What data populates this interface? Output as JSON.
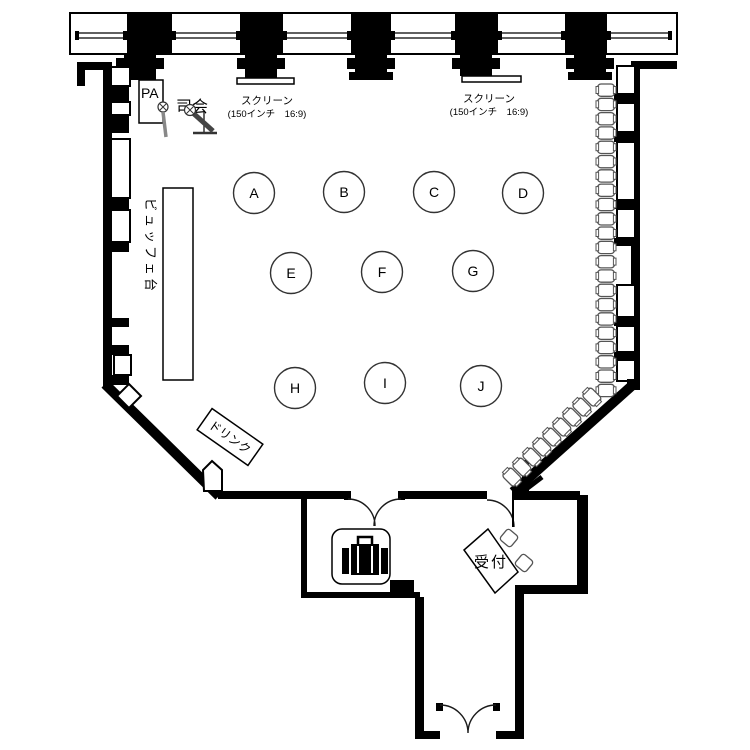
{
  "stage": {
    "pa_label": "PA",
    "mc_label": "司会",
    "screens": [
      {
        "name": "スクリーン",
        "spec": "(150インチ　16:9)"
      },
      {
        "name": "スクリーン",
        "spec": "(150インチ　16:9)"
      }
    ]
  },
  "hall": {
    "buffet_label": "ビュッフェ台",
    "drink_label": "ドリンク",
    "tables": [
      {
        "label": "A",
        "x": 254,
        "y": 193
      },
      {
        "label": "B",
        "x": 344,
        "y": 192
      },
      {
        "label": "C",
        "x": 434,
        "y": 192
      },
      {
        "label": "D",
        "x": 523,
        "y": 193
      },
      {
        "label": "E",
        "x": 291,
        "y": 273
      },
      {
        "label": "F",
        "x": 382,
        "y": 272
      },
      {
        "label": "G",
        "x": 473,
        "y": 271
      },
      {
        "label": "H",
        "x": 295,
        "y": 388
      },
      {
        "label": "I",
        "x": 385,
        "y": 383
      },
      {
        "label": "J",
        "x": 481,
        "y": 386
      }
    ],
    "stacked_chairs": {
      "right_wall": {
        "count": 22,
        "x": 606,
        "y_start": 90,
        "pitch": 14.3,
        "angle": 0
      },
      "diagonal": {
        "count": 9,
        "x_start": 592,
        "y_start": 397,
        "dx": -10,
        "dy": 10,
        "angle": 45
      }
    }
  },
  "entrance": {
    "reception_label": "受付",
    "cloak_icon": "suitcase-icon"
  }
}
